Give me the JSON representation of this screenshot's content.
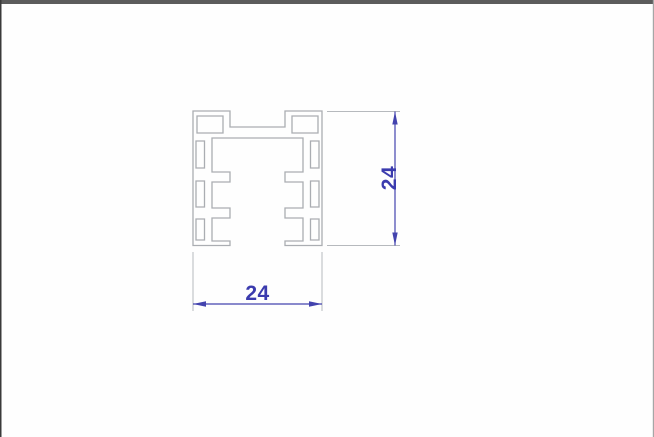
{
  "window": {
    "background": "#fefefe",
    "top_border_color": "#5c5c5c",
    "left_border_color": "#3a3a3a",
    "right_border_color": "#a6a6a6"
  },
  "drawing": {
    "profile": {
      "stroke": "#aaadb2",
      "outline_path": "M 193,111 L 230,111 L 230,127 L 285,127 L 285,111 L 322,111 L 322,245.5 L 285,245.5 L 285,241 L 303,241 L 303,218 L 285,218 L 285,208 L 303,208 L 303,182 L 285,182 L 285,172 L 303,172 L 303,138 L 212,138 L 212,172 L 230,172 L 230,182 L 212,182 L 212,208 L 230,208 L 230,218 L 212,218 L 212,241 L 230,241 L 230,245.5 L 193,245.5 Z",
      "corner_holes_path": "M 197,116 L 223,116 L 223,133 L 197,133 Z M 292,116 L 318,116 L 318,133 L 292,133 Z",
      "side_slots_path": "M 196,141 L 204.5,141 L 204.5,168 L 196,168 Z M 196,181 L 204.5,181 L 204.5,207 L 196,207 Z M 196,219 L 204.5,219 L 204.5,240 L 196,240 Z M 310.5,141 L 319,141 L 319,168 L 310.5,168 Z M 310.5,181 L 319,181 L 319,207 L 310.5,207 Z M 310.5,219 L 319,219 L 319,240 L 310.5,240 Z"
    },
    "dimensions": {
      "color": "#4343ae",
      "text_color": "#3b3bae",
      "extension_color": "#b6b9bd",
      "width": {
        "label": "24",
        "ext_path": "M 193,252 L 193,311 M 322,252 L 322,311",
        "line_path": "M 193,304 L 322,304",
        "arrows_path": "M 193,304 L 206,301.3 L 206,306.7 Z M 322,304 L 309,301.3 L 309,306.7 Z"
      },
      "height": {
        "label": "24",
        "ext_path": "M 327,111.5 L 400,111.5 M 327,245.5 L 400,245.5",
        "line_path": "M 395,111.5 L 395,245.5",
        "arrows_path": "M 395,111.5 L 392.3,124.5 L 397.7,124.5 Z M 395,245.5 L 392.3,232.5 L 397.7,232.5 Z"
      }
    }
  }
}
